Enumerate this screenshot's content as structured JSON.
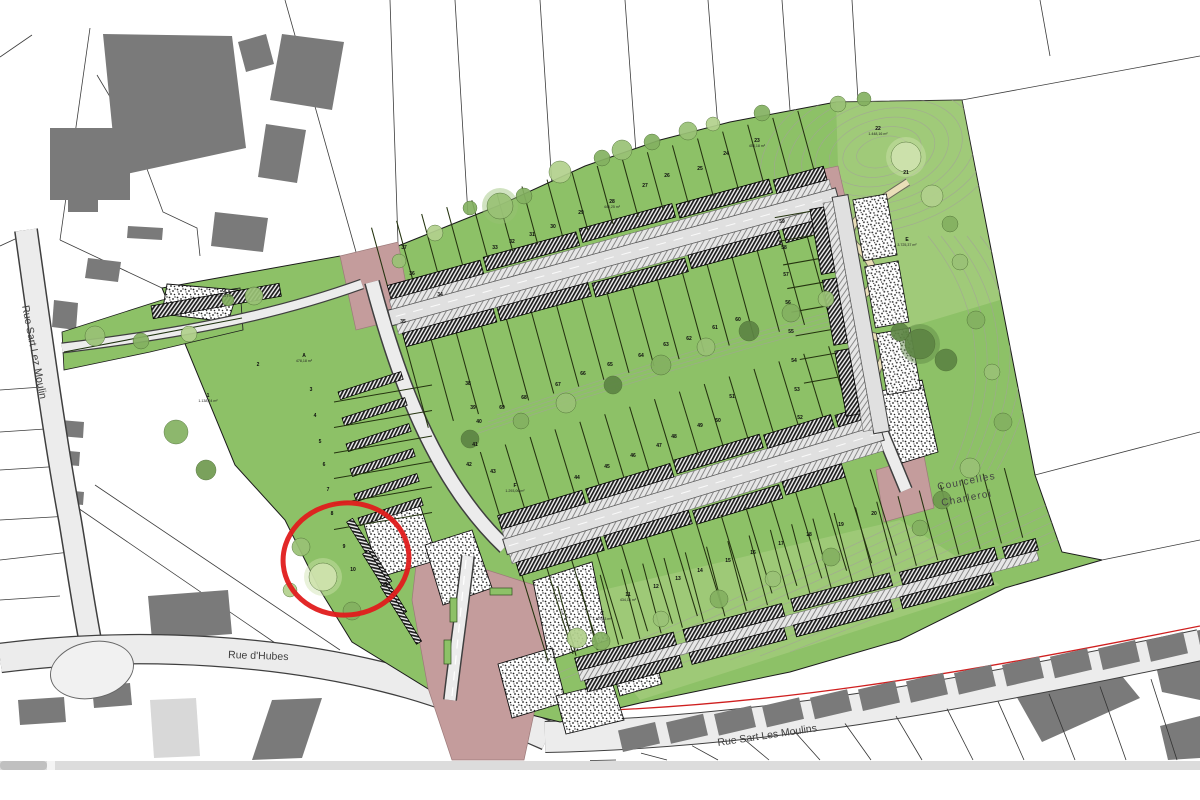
{
  "viewer": {
    "scrollbar_orientation": "horizontal"
  },
  "colors": {
    "site_green": "#8dc167",
    "light_green_overlay": "#c6dd9a",
    "road_gray": "#ececec",
    "paved_pink": "#c49c9c",
    "building_gray": "#7a7a7a",
    "annotation_red": "#e01c1c",
    "path_cream": "#eadfb8",
    "hedge_dark_green": "#1f3310",
    "scrollbar_track": "#dcdcdc",
    "scrollbar_thumb": "#c0c0c0",
    "plan_limit_red_line": "#cf1f1f"
  },
  "streets": {
    "rue_dhubes": "Rue d'Hubes",
    "rue_sart_les_moulins": "Rue Sart Les Moulins",
    "rue_sart_lez_moulin": "Rue Sart Lez Moulin"
  },
  "places": {
    "courcelles": "Courcelles",
    "charleroi": "Charleroi"
  },
  "labels": {
    "stipple_basin": "Bassin d'orage"
  },
  "annotation": {
    "shape": "ellipse",
    "color": "#e01c1c",
    "cx": 346,
    "cy": 559,
    "rx": 63,
    "ry": 56,
    "rotation": -6,
    "stroke_width": 5
  },
  "tree_palette": [
    "#6f9a4f",
    "#84b161",
    "#9ac276",
    "#b2d18d",
    "#cfe3ae",
    "#5d8544"
  ],
  "plots": [
    {
      "n": "G",
      "x": 224,
      "y": 292,
      "a": "1.129,27 m²"
    },
    {
      "n": "1",
      "x": 208,
      "y": 397,
      "a": "1.138,24 m²"
    },
    {
      "n": "2",
      "x": 258,
      "y": 366
    },
    {
      "n": "A",
      "x": 304,
      "y": 357,
      "a": "478,18 m²"
    },
    {
      "n": "3",
      "x": 311,
      "y": 391
    },
    {
      "n": "4",
      "x": 315,
      "y": 417
    },
    {
      "n": "5",
      "x": 320,
      "y": 443
    },
    {
      "n": "6",
      "x": 324,
      "y": 466
    },
    {
      "n": "7",
      "x": 328,
      "y": 491
    },
    {
      "n": "8",
      "x": 332,
      "y": 515
    },
    {
      "n": "9",
      "x": 344,
      "y": 548
    },
    {
      "n": "10",
      "x": 353,
      "y": 571
    },
    {
      "n": "D",
      "x": 386,
      "y": 586
    },
    {
      "n": "11",
      "x": 628,
      "y": 596,
      "a": "434,16 m²"
    },
    {
      "n": "12",
      "x": 656,
      "y": 588
    },
    {
      "n": "13",
      "x": 678,
      "y": 580
    },
    {
      "n": "14",
      "x": 700,
      "y": 572
    },
    {
      "n": "15",
      "x": 728,
      "y": 562
    },
    {
      "n": "16",
      "x": 753,
      "y": 554
    },
    {
      "n": "17",
      "x": 781,
      "y": 545
    },
    {
      "n": "18",
      "x": 809,
      "y": 536
    },
    {
      "n": "19",
      "x": 841,
      "y": 526
    },
    {
      "n": "20",
      "x": 874,
      "y": 515
    },
    {
      "n": "21",
      "x": 906,
      "y": 174
    },
    {
      "n": "22",
      "x": 878,
      "y": 130,
      "a": "1.448,16 m²"
    },
    {
      "n": "23",
      "x": 757,
      "y": 142,
      "a": "453,18 m²"
    },
    {
      "n": "24",
      "x": 726,
      "y": 155
    },
    {
      "n": "25",
      "x": 700,
      "y": 170
    },
    {
      "n": "26",
      "x": 667,
      "y": 177
    },
    {
      "n": "27",
      "x": 645,
      "y": 187
    },
    {
      "n": "28",
      "x": 612,
      "y": 203,
      "a": "446,25 m²"
    },
    {
      "n": "29",
      "x": 581,
      "y": 214
    },
    {
      "n": "30",
      "x": 553,
      "y": 228
    },
    {
      "n": "31",
      "x": 532,
      "y": 236
    },
    {
      "n": "32",
      "x": 512,
      "y": 243
    },
    {
      "n": "33",
      "x": 495,
      "y": 249
    },
    {
      "n": "34",
      "x": 440,
      "y": 296
    },
    {
      "n": "35",
      "x": 403,
      "y": 323
    },
    {
      "n": "36",
      "x": 412,
      "y": 275
    },
    {
      "n": "37",
      "x": 404,
      "y": 249
    },
    {
      "n": "38",
      "x": 468,
      "y": 385
    },
    {
      "n": "39",
      "x": 473,
      "y": 409
    },
    {
      "n": "40",
      "x": 479,
      "y": 423
    },
    {
      "n": "41",
      "x": 475,
      "y": 446
    },
    {
      "n": "42",
      "x": 469,
      "y": 466
    },
    {
      "n": "43",
      "x": 493,
      "y": 473
    },
    {
      "n": "44",
      "x": 577,
      "y": 479
    },
    {
      "n": "45",
      "x": 607,
      "y": 468
    },
    {
      "n": "46",
      "x": 633,
      "y": 457
    },
    {
      "n": "47",
      "x": 659,
      "y": 447
    },
    {
      "n": "48",
      "x": 674,
      "y": 438
    },
    {
      "n": "49",
      "x": 700,
      "y": 427
    },
    {
      "n": "50",
      "x": 718,
      "y": 422
    },
    {
      "n": "51",
      "x": 732,
      "y": 398
    },
    {
      "n": "52",
      "x": 800,
      "y": 419
    },
    {
      "n": "53",
      "x": 797,
      "y": 391
    },
    {
      "n": "54",
      "x": 794,
      "y": 362
    },
    {
      "n": "55",
      "x": 791,
      "y": 333
    },
    {
      "n": "56",
      "x": 788,
      "y": 304
    },
    {
      "n": "57",
      "x": 786,
      "y": 276
    },
    {
      "n": "58",
      "x": 784,
      "y": 249
    },
    {
      "n": "59",
      "x": 782,
      "y": 223
    },
    {
      "n": "60",
      "x": 738,
      "y": 321
    },
    {
      "n": "61",
      "x": 715,
      "y": 329
    },
    {
      "n": "62",
      "x": 689,
      "y": 340
    },
    {
      "n": "63",
      "x": 666,
      "y": 346
    },
    {
      "n": "64",
      "x": 641,
      "y": 357
    },
    {
      "n": "65",
      "x": 610,
      "y": 366
    },
    {
      "n": "66",
      "x": 583,
      "y": 375
    },
    {
      "n": "67",
      "x": 558,
      "y": 386
    },
    {
      "n": "68",
      "x": 524,
      "y": 399
    },
    {
      "n": "69",
      "x": 502,
      "y": 409
    },
    {
      "n": "C",
      "x": 602,
      "y": 615,
      "a": "1.129,63 m²"
    },
    {
      "n": "E",
      "x": 907,
      "y": 241,
      "a": "3.725,37 m²"
    },
    {
      "n": "F",
      "x": 515,
      "y": 487,
      "a": "1.293,06 m²"
    }
  ],
  "trees": [
    [
      500,
      206,
      13,
      2
    ],
    [
      524,
      196,
      8,
      1
    ],
    [
      560,
      172,
      11,
      3
    ],
    [
      602,
      158,
      8,
      1
    ],
    [
      622,
      150,
      10,
      2
    ],
    [
      652,
      142,
      8,
      1
    ],
    [
      688,
      131,
      9,
      2
    ],
    [
      713,
      124,
      7,
      3
    ],
    [
      762,
      113,
      8,
      1
    ],
    [
      838,
      104,
      8,
      2
    ],
    [
      864,
      99,
      7,
      1
    ],
    [
      906,
      157,
      15,
      4
    ],
    [
      932,
      196,
      11,
      3
    ],
    [
      950,
      224,
      8,
      1
    ],
    [
      960,
      262,
      8,
      2
    ],
    [
      976,
      320,
      9,
      1
    ],
    [
      992,
      372,
      8,
      2
    ],
    [
      1003,
      422,
      9,
      1
    ],
    [
      970,
      468,
      10,
      2
    ],
    [
      942,
      500,
      9,
      0
    ],
    [
      920,
      528,
      8,
      1
    ],
    [
      920,
      344,
      15,
      5
    ],
    [
      946,
      360,
      11,
      5
    ],
    [
      900,
      332,
      9,
      5
    ],
    [
      95,
      336,
      10,
      2
    ],
    [
      141,
      341,
      8,
      1
    ],
    [
      189,
      334,
      8,
      3
    ],
    [
      254,
      296,
      9,
      2
    ],
    [
      228,
      300,
      6,
      1
    ],
    [
      176,
      432,
      12,
      1
    ],
    [
      206,
      470,
      10,
      0
    ],
    [
      301,
      547,
      9,
      2
    ],
    [
      323,
      577,
      14,
      4
    ],
    [
      352,
      611,
      9,
      1
    ],
    [
      290,
      590,
      7,
      3
    ],
    [
      470,
      439,
      9,
      5
    ],
    [
      521,
      421,
      8,
      1
    ],
    [
      566,
      403,
      10,
      2
    ],
    [
      613,
      385,
      9,
      5
    ],
    [
      661,
      365,
      10,
      1
    ],
    [
      706,
      347,
      9,
      2
    ],
    [
      749,
      331,
      10,
      5
    ],
    [
      791,
      313,
      9,
      1
    ],
    [
      826,
      299,
      8,
      2
    ],
    [
      601,
      641,
      9,
      1
    ],
    [
      661,
      619,
      8,
      2
    ],
    [
      719,
      599,
      9,
      1
    ],
    [
      773,
      579,
      8,
      2
    ],
    [
      831,
      557,
      9,
      1
    ],
    [
      577,
      638,
      10,
      3
    ],
    [
      435,
      233,
      8,
      3
    ],
    [
      399,
      261,
      7,
      2
    ],
    [
      470,
      208,
      7,
      1
    ]
  ]
}
